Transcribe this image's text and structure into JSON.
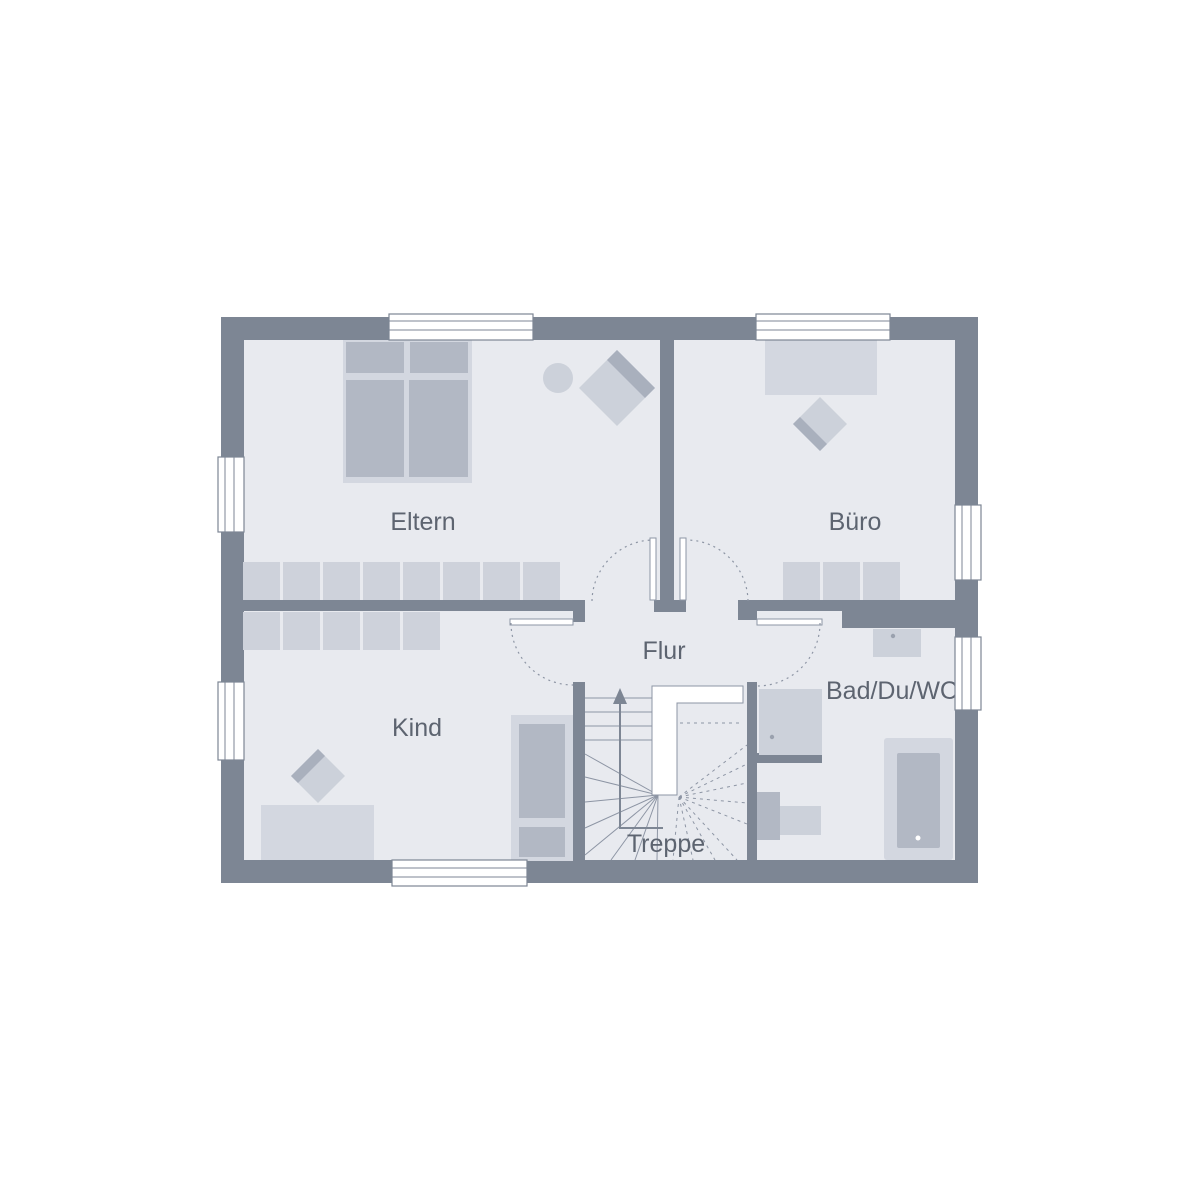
{
  "labels": {
    "eltern": "Eltern",
    "buero": "Büro",
    "flur": "Flur",
    "kind": "Kind",
    "bad": "Bad/Du/WC",
    "treppe": "Treppe"
  },
  "colors": {
    "bg": "#ffffff",
    "wall": "#7d8694",
    "floor": "#e8eaef",
    "furn-light": "#d3d7e0",
    "furn-mid": "#ccd1da",
    "furn-dark": "#b2b8c4",
    "chair-band": "#a9b0bd",
    "wardrobe": "#ced2db",
    "fixture-dot": "#9aa1ae",
    "line": "#8d95a4",
    "text": "#5d6470",
    "window": "#ffffff"
  }
}
